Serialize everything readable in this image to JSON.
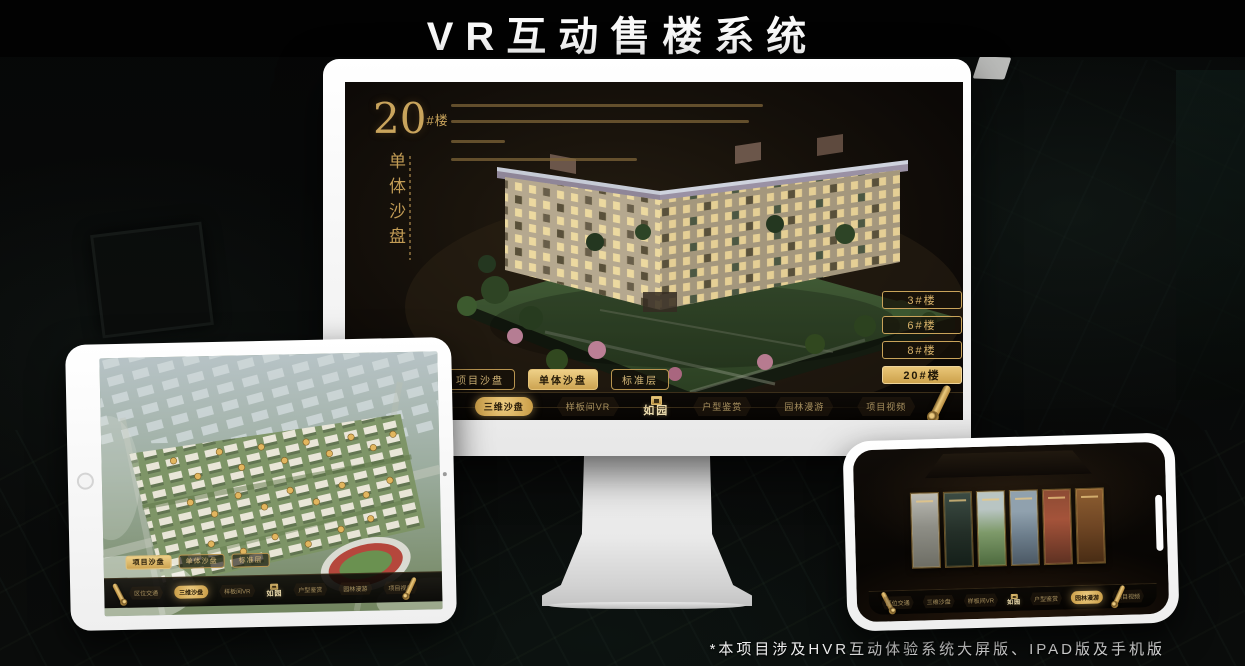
{
  "page": {
    "title": "VR互动售楼系统",
    "footnote": "*本项目涉及HVR互动体验系统大屏版、IPAD版及手机版"
  },
  "colors": {
    "gold": "#c9a35a",
    "gold_bright": "#ecca7e",
    "screen_bg": "#16110b",
    "nav_bar_bg": "#0a0705",
    "title_color": "#fafafa"
  },
  "menu": {
    "logo": "如园",
    "items": [
      {
        "label": "区位交通"
      },
      {
        "label": "三维沙盘"
      },
      {
        "label": "样板间VR"
      },
      {
        "label": "户型鉴赏"
      },
      {
        "label": "园林漫游"
      },
      {
        "label": "项目视频"
      }
    ]
  },
  "tabs": [
    {
      "label": "项目沙盘"
    },
    {
      "label": "单体沙盘"
    },
    {
      "label": "标准层"
    }
  ],
  "monitor": {
    "headline_number": "20",
    "headline_suffix": "#楼",
    "headline_sub": "单体沙盘",
    "active_tab": "单体沙盘",
    "active_menu": "三维沙盘",
    "floor_buttons": [
      {
        "label": "3#楼",
        "active": false
      },
      {
        "label": "6#楼",
        "active": false
      },
      {
        "label": "8#楼",
        "active": false
      },
      {
        "label": "20#楼",
        "active": true
      }
    ]
  },
  "tablet": {
    "active_tab": "项目沙盘",
    "active_menu": "三维沙盘"
  },
  "phone": {
    "active_menu": "园林漫游"
  }
}
